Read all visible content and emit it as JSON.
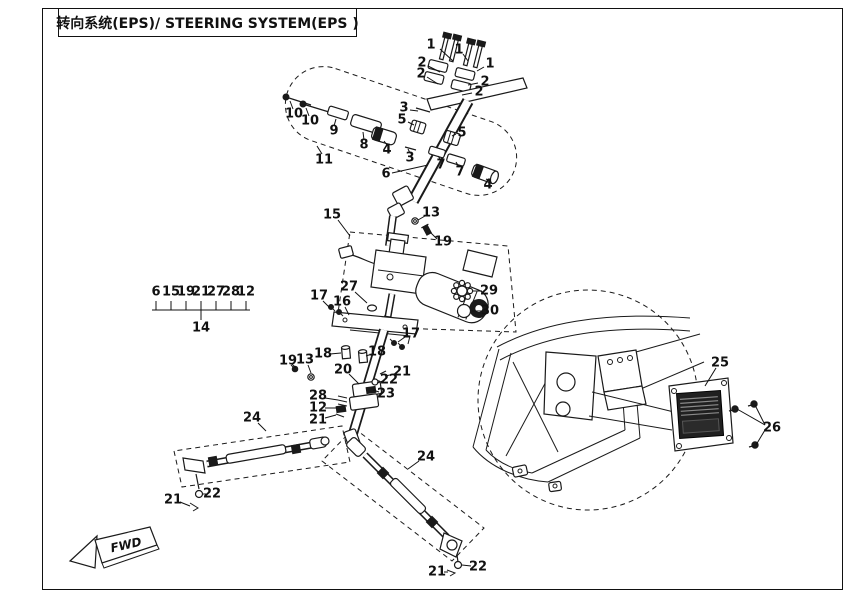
{
  "meta": {
    "bg": "#ffffff",
    "ink": "#1a1a1a",
    "width": 860,
    "height": 600
  },
  "header": {
    "title": "转向系统(EPS)/ STEERING SYSTEM(EPS )"
  },
  "fwd": {
    "label": "FWD"
  },
  "group14": {
    "top_numbers": [
      "6",
      "15",
      "19",
      "21",
      "27",
      "28",
      "12"
    ],
    "bottom": "14"
  },
  "callouts": [
    {
      "label": "1",
      "x": 431,
      "y": 45,
      "leaders": [
        [
          440,
          49,
          453,
          61
        ]
      ]
    },
    {
      "label": "1",
      "x": 459,
      "y": 50,
      "leaders": [
        [
          463,
          54,
          468,
          61
        ]
      ]
    },
    {
      "label": "1",
      "x": 490,
      "y": 64,
      "leaders": [
        [
          484,
          67,
          477,
          71
        ]
      ]
    },
    {
      "label": "2",
      "x": 422,
      "y": 63,
      "leaders": [
        [
          428,
          66,
          440,
          72
        ]
      ]
    },
    {
      "label": "2",
      "x": 421,
      "y": 74,
      "leaders": [
        [
          427,
          77,
          438,
          84
        ]
      ]
    },
    {
      "label": "2",
      "x": 485,
      "y": 82,
      "leaders": [
        [
          478,
          83,
          468,
          85
        ]
      ]
    },
    {
      "label": "2",
      "x": 479,
      "y": 92,
      "leaders": [
        [
          472,
          93,
          462,
          95
        ]
      ]
    },
    {
      "label": "3",
      "x": 404,
      "y": 108,
      "leaders": [
        [
          410,
          110,
          418,
          111
        ]
      ]
    },
    {
      "label": "5",
      "x": 402,
      "y": 120,
      "leaders": [
        [
          408,
          122,
          414,
          125
        ]
      ]
    },
    {
      "label": "3",
      "x": 410,
      "y": 158,
      "leaders": [
        [
          410,
          153,
          408,
          149
        ]
      ]
    },
    {
      "label": "5",
      "x": 462,
      "y": 133,
      "leaders": [
        [
          456,
          134,
          452,
          136
        ]
      ]
    },
    {
      "label": "7",
      "x": 441,
      "y": 165,
      "leaders": [
        [
          441,
          160,
          438,
          156
        ]
      ]
    },
    {
      "label": "7",
      "x": 460,
      "y": 172,
      "leaders": [
        [
          459,
          167,
          456,
          162
        ]
      ]
    },
    {
      "label": "4",
      "x": 387,
      "y": 150,
      "leaders": [
        [
          387,
          145,
          384,
          141
        ]
      ]
    },
    {
      "label": "4",
      "x": 488,
      "y": 185,
      "leaders": [
        [
          488,
          180,
          486,
          179
        ]
      ]
    },
    {
      "label": "6",
      "x": 386,
      "y": 174,
      "leaders": [
        [
          392,
          173,
          428,
          165
        ]
      ]
    },
    {
      "label": "8",
      "x": 364,
      "y": 145,
      "leaders": [
        [
          364,
          140,
          363,
          132
        ]
      ]
    },
    {
      "label": "9",
      "x": 334,
      "y": 131,
      "leaders": [
        [
          334,
          126,
          336,
          119
        ]
      ]
    },
    {
      "label": "10",
      "x": 294,
      "y": 114,
      "leaders": [
        [
          293,
          109,
          290,
          101
        ]
      ]
    },
    {
      "label": "10",
      "x": 310,
      "y": 121,
      "leaders": [
        [
          309,
          116,
          306,
          108
        ]
      ]
    },
    {
      "label": "11",
      "x": 324,
      "y": 160,
      "leaders": [
        [
          322,
          154,
          317,
          146
        ]
      ]
    },
    {
      "label": "13",
      "x": 431,
      "y": 213,
      "leaders": [
        [
          425,
          216,
          418,
          220
        ]
      ]
    },
    {
      "label": "19",
      "x": 443,
      "y": 242,
      "leaders": [
        [
          437,
          239,
          430,
          232
        ]
      ]
    },
    {
      "label": "15",
      "x": 332,
      "y": 215,
      "leaders": [
        [
          338,
          220,
          350,
          236
        ]
      ]
    },
    {
      "label": "27",
      "x": 349,
      "y": 287,
      "leaders": [
        [
          355,
          292,
          367,
          303
        ]
      ]
    },
    {
      "label": "16",
      "x": 342,
      "y": 302,
      "leaders": [
        [
          345,
          307,
          349,
          315
        ]
      ]
    },
    {
      "label": "29",
      "x": 489,
      "y": 291,
      "leaders": [
        [
          482,
          291,
          473,
          291
        ]
      ]
    },
    {
      "label": "30",
      "x": 490,
      "y": 311,
      "leaders": [
        [
          483,
          311,
          472,
          311
        ]
      ]
    },
    {
      "label": "17",
      "x": 319,
      "y": 296,
      "leaders": [
        [
          323,
          301,
          330,
          308
        ]
      ]
    },
    {
      "label": "17",
      "x": 411,
      "y": 334,
      "leaders": [
        [
          405,
          337,
          398,
          342
        ]
      ]
    },
    {
      "label": "18",
      "x": 323,
      "y": 354,
      "leaders": [
        [
          330,
          354,
          341,
          353
        ]
      ]
    },
    {
      "label": "18",
      "x": 377,
      "y": 352,
      "leaders": [
        [
          372,
          354,
          366,
          356
        ]
      ]
    },
    {
      "label": "19",
      "x": 288,
      "y": 361,
      "leaders": [
        [
          292,
          364,
          296,
          368
        ]
      ]
    },
    {
      "label": "13",
      "x": 305,
      "y": 360,
      "leaders": [
        [
          308,
          365,
          311,
          373
        ]
      ]
    },
    {
      "label": "20",
      "x": 343,
      "y": 370,
      "leaders": [
        [
          349,
          374,
          359,
          384
        ]
      ]
    },
    {
      "label": "21",
      "x": 402,
      "y": 372,
      "leaders": [
        [
          395,
          374,
          385,
          376
        ]
      ]
    },
    {
      "label": "22",
      "x": 389,
      "y": 380,
      "leaders": [
        [
          383,
          381,
          377,
          383
        ]
      ]
    },
    {
      "label": "23",
      "x": 386,
      "y": 394,
      "leaders": [
        [
          379,
          392,
          373,
          390
        ]
      ]
    },
    {
      "label": "28",
      "x": 318,
      "y": 396,
      "leaders": [
        [
          325,
          398,
          338,
          400
        ]
      ]
    },
    {
      "label": "12",
      "x": 318,
      "y": 408,
      "leaders": [
        [
          325,
          408,
          337,
          408
        ]
      ]
    },
    {
      "label": "21",
      "x": 318,
      "y": 420,
      "leaders": [
        [
          325,
          418,
          336,
          415
        ]
      ]
    },
    {
      "label": "24",
      "x": 252,
      "y": 418,
      "leaders": [
        [
          258,
          423,
          266,
          431
        ]
      ]
    },
    {
      "label": "24",
      "x": 426,
      "y": 457,
      "leaders": [
        [
          419,
          461,
          408,
          469
        ]
      ]
    },
    {
      "label": "22",
      "x": 212,
      "y": 494,
      "leaders": [
        [
          206,
          494,
          203,
          494
        ]
      ]
    },
    {
      "label": "21",
      "x": 173,
      "y": 500,
      "leaders": [
        [
          180,
          502,
          190,
          506
        ]
      ]
    },
    {
      "label": "21",
      "x": 437,
      "y": 572,
      "leaders": [
        [
          444,
          572,
          448,
          572
        ]
      ]
    },
    {
      "label": "22",
      "x": 478,
      "y": 567,
      "leaders": [
        [
          471,
          566,
          462,
          565
        ]
      ]
    },
    {
      "label": "25",
      "x": 720,
      "y": 363,
      "leaders": [
        [
          716,
          368,
          705,
          386
        ]
      ]
    },
    {
      "label": "26",
      "x": 772,
      "y": 428,
      "leaders": [
        [
          765,
          425,
          737,
          409
        ],
        [
          765,
          425,
          755,
          405
        ],
        [
          765,
          430,
          756,
          445
        ]
      ]
    }
  ]
}
